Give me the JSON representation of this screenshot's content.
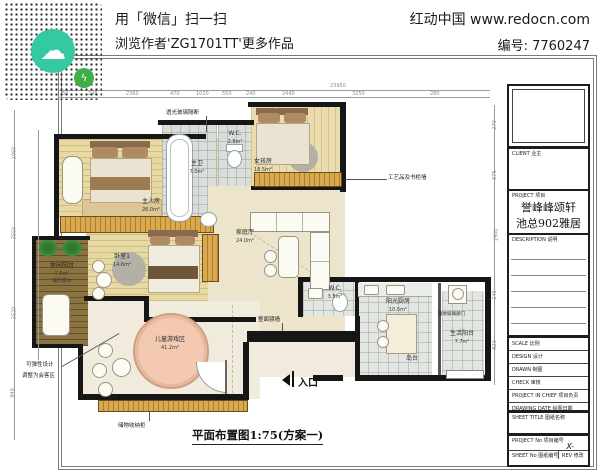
{
  "header": {
    "line1": "用「微信」扫一扫",
    "line2": "浏览作者'ZG1701TT'更多作品",
    "brand": "红动中国 www.redocn.com",
    "code": "编号: 7760247"
  },
  "plan": {
    "title": "平面布置图1:75(方案一)",
    "total_dim": "23950",
    "dims_top": [
      "50",
      "248",
      "2360",
      "470",
      "1020",
      "550",
      "240",
      "2440",
      "3250",
      "280"
    ],
    "dims_right": [
      "270",
      "575",
      "1900",
      "245",
      "820"
    ],
    "dims_left": [
      "1060",
      "3550",
      "2520",
      "940",
      "7060"
    ],
    "rooms": {
      "master": {
        "name": "主人房",
        "area": "26.0m²"
      },
      "master_bath": {
        "name": "主卫",
        "area": "7.0m²"
      },
      "wc1": {
        "name": "W.C.",
        "area": "2.8m²"
      },
      "girl": {
        "name": "女孩房",
        "area": "18.5m²"
      },
      "bedroom1": {
        "name": "卧室1",
        "area": "14.6m²"
      },
      "family": {
        "name": "家庭厅",
        "area": "24.0m²"
      },
      "play": {
        "name": "儿童游戏区",
        "area": "41.2m²"
      },
      "wc2": {
        "name": "W.C.",
        "area": "3.5m²"
      },
      "kitchen": {
        "name": "阳光厨房",
        "area": "10.5m²"
      },
      "island": {
        "name": "岛台"
      },
      "service_balcony": {
        "name": "生活阳台",
        "area": "7.7m²"
      },
      "leisure_balcony": {
        "name": "休闲阳台",
        "area": "7.5m²",
        "note": "铺防腐木"
      }
    },
    "annotations": {
      "glass_partition": "透光玻璃隔断",
      "bookcase_wall": "工艺品及书柜墙",
      "mirror_wall": "整面镜墙",
      "storage_cabinet": "储物收纳柜",
      "flex_line1": "可弹性设计",
      "flex_line2": "调整为会客区",
      "glass_door": "落地玻璃趟门",
      "entrance": "入口"
    }
  },
  "titleblock": {
    "client": "CLIENT  业主",
    "project": "PROJECT  项目",
    "project_name1": "誉峰峰颂轩",
    "project_name2": "池总902雅居",
    "description": "DESCRIPTION  说明",
    "scale": "SCALE  比例",
    "design": "DESIGN  设计",
    "drawn": "DRAWN  制图",
    "check": "CHECK  审核",
    "chief": "PROJECT IN CHIEF  项目负责",
    "date": "DRAWING DATE  绘图日期",
    "sheet_title": "SHEET TITLE  图纸名称",
    "project_no": "PROJECT No  项目编号",
    "x_mark": "X-",
    "sheet_no": "SHEET No  图纸编号",
    "rev": "REV  修改"
  }
}
